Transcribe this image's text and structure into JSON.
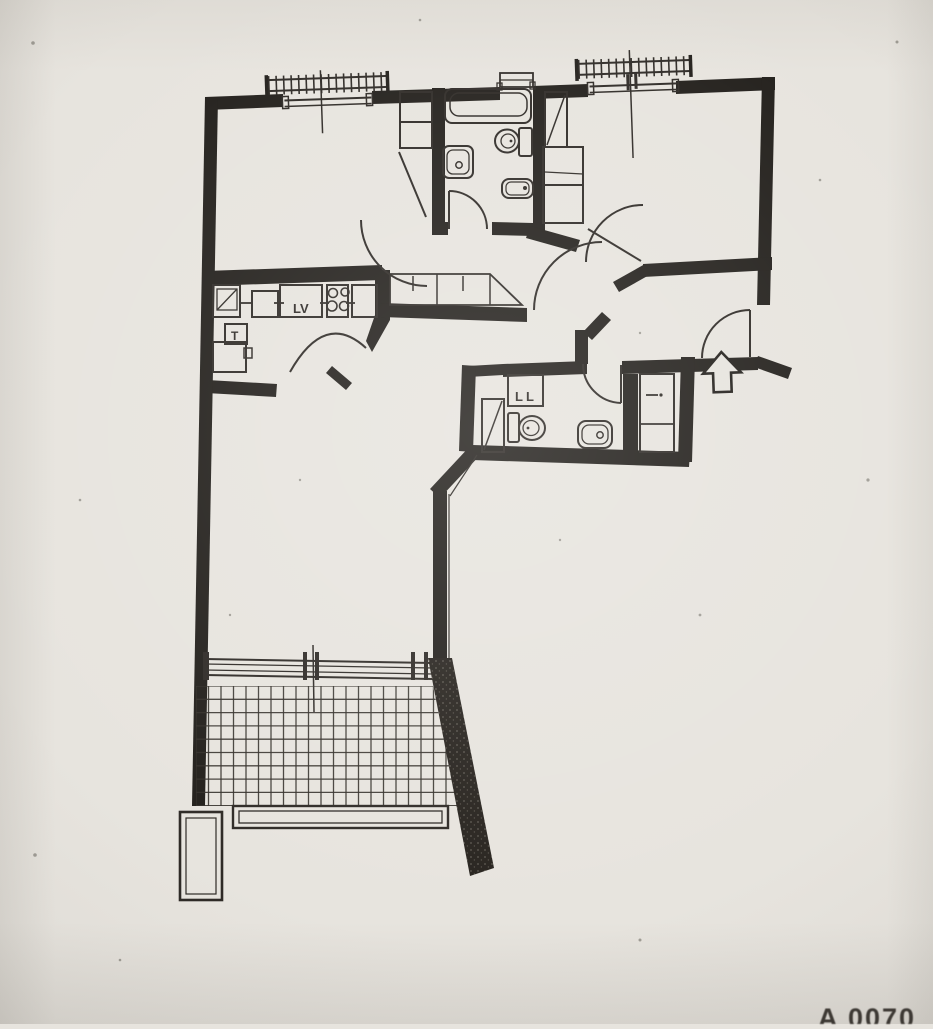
{
  "document": {
    "kind": "scanned apartment floor plan",
    "orientation_note": "photo of paper plan, slightly tilted"
  },
  "colors": {
    "paper": "#e7e4de",
    "paper_edge": "#d9d6cf",
    "ink": "#221f1b",
    "line": "#2e2a26"
  },
  "plan": {
    "labels": {
      "dishwasher": "LV",
      "kitchen_box": "T",
      "washing_machine": "LL"
    },
    "watermark_fragment": "A 0070",
    "rooms": [
      "bedroom-1",
      "bathroom-1",
      "bedroom-2",
      "hallway",
      "kitchen",
      "entry",
      "wc-bathroom-2",
      "living-room",
      "balcony"
    ],
    "fixtures": [
      "bathtub",
      "washbasin-1",
      "toilet-1",
      "bidet",
      "window-railing-1",
      "window-railing-2",
      "bathroom-window",
      "kitchen-sink",
      "cooktop-4-burners",
      "dishwasher",
      "toilet-2",
      "washbasin-2",
      "washing-machine",
      "ventilation-duct-1",
      "ventilation-duct-2",
      "wardrobe-bedroom-1",
      "wardrobe-bedroom-2",
      "hallway-closet",
      "entry-closet",
      "entry-arrow",
      "sliding-door",
      "balcony-tile-grid",
      "balcony-railing",
      "planter"
    ]
  }
}
